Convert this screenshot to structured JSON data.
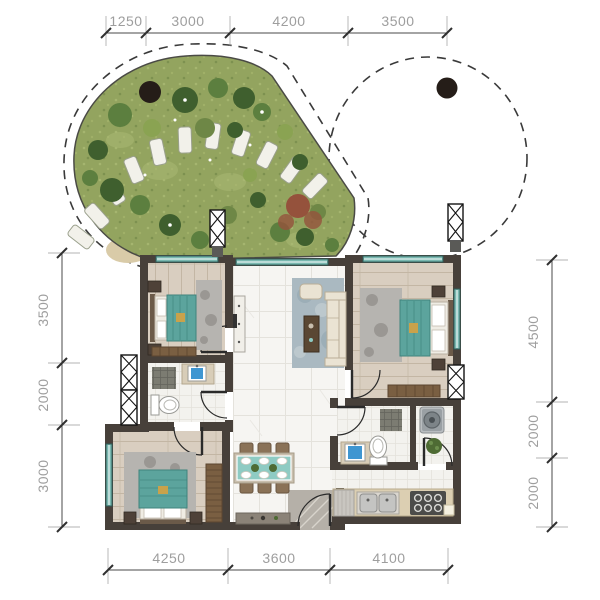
{
  "title": "apartment-floor-plan",
  "dimensions": {
    "top": [
      "1250",
      "3000",
      "4200",
      "3500"
    ],
    "bottom": [
      "4250",
      "3600",
      "4100"
    ],
    "left": [
      "3500",
      "2000",
      "3000"
    ],
    "right": [
      "4500",
      "2000",
      "2000"
    ]
  },
  "colors": {
    "wall": "#47403a",
    "window_frame": "#2e5d58",
    "window_fill": "#79b8b0",
    "wood": "#d9cec0",
    "wood_line": "#c3b6a4",
    "tile": "#f6f5f2",
    "tile_line": "#e4e2dc",
    "tile_small": "#f3f2ee",
    "bed": "#5ca49d",
    "bed_edge": "#3f837d",
    "rug": "#b6b4b0",
    "rug_spot": "#908e8a",
    "living_rug": "#aab9c1",
    "cream": "#eae3d3",
    "brown": "#8a7257",
    "dark_brown": "#5a4733",
    "wood_furn": "#7a5f42",
    "counter": "#dccfb2",
    "sink_blue": "#3f96d1",
    "stone": "#b5b0a8",
    "grass": "#93a45f",
    "tree_dark": "#3f5f2e",
    "tree_mid": "#5c7f3f",
    "tree_light": "#8aa352",
    "tree_olive": "#6e8746",
    "shrub_red": "#95523c",
    "stone_path": "#f2f1ea",
    "dim_line": "#4a4a4a",
    "dim_text": "#9e9e9e",
    "dot": "#251d18",
    "mat": "#7c7c72"
  }
}
